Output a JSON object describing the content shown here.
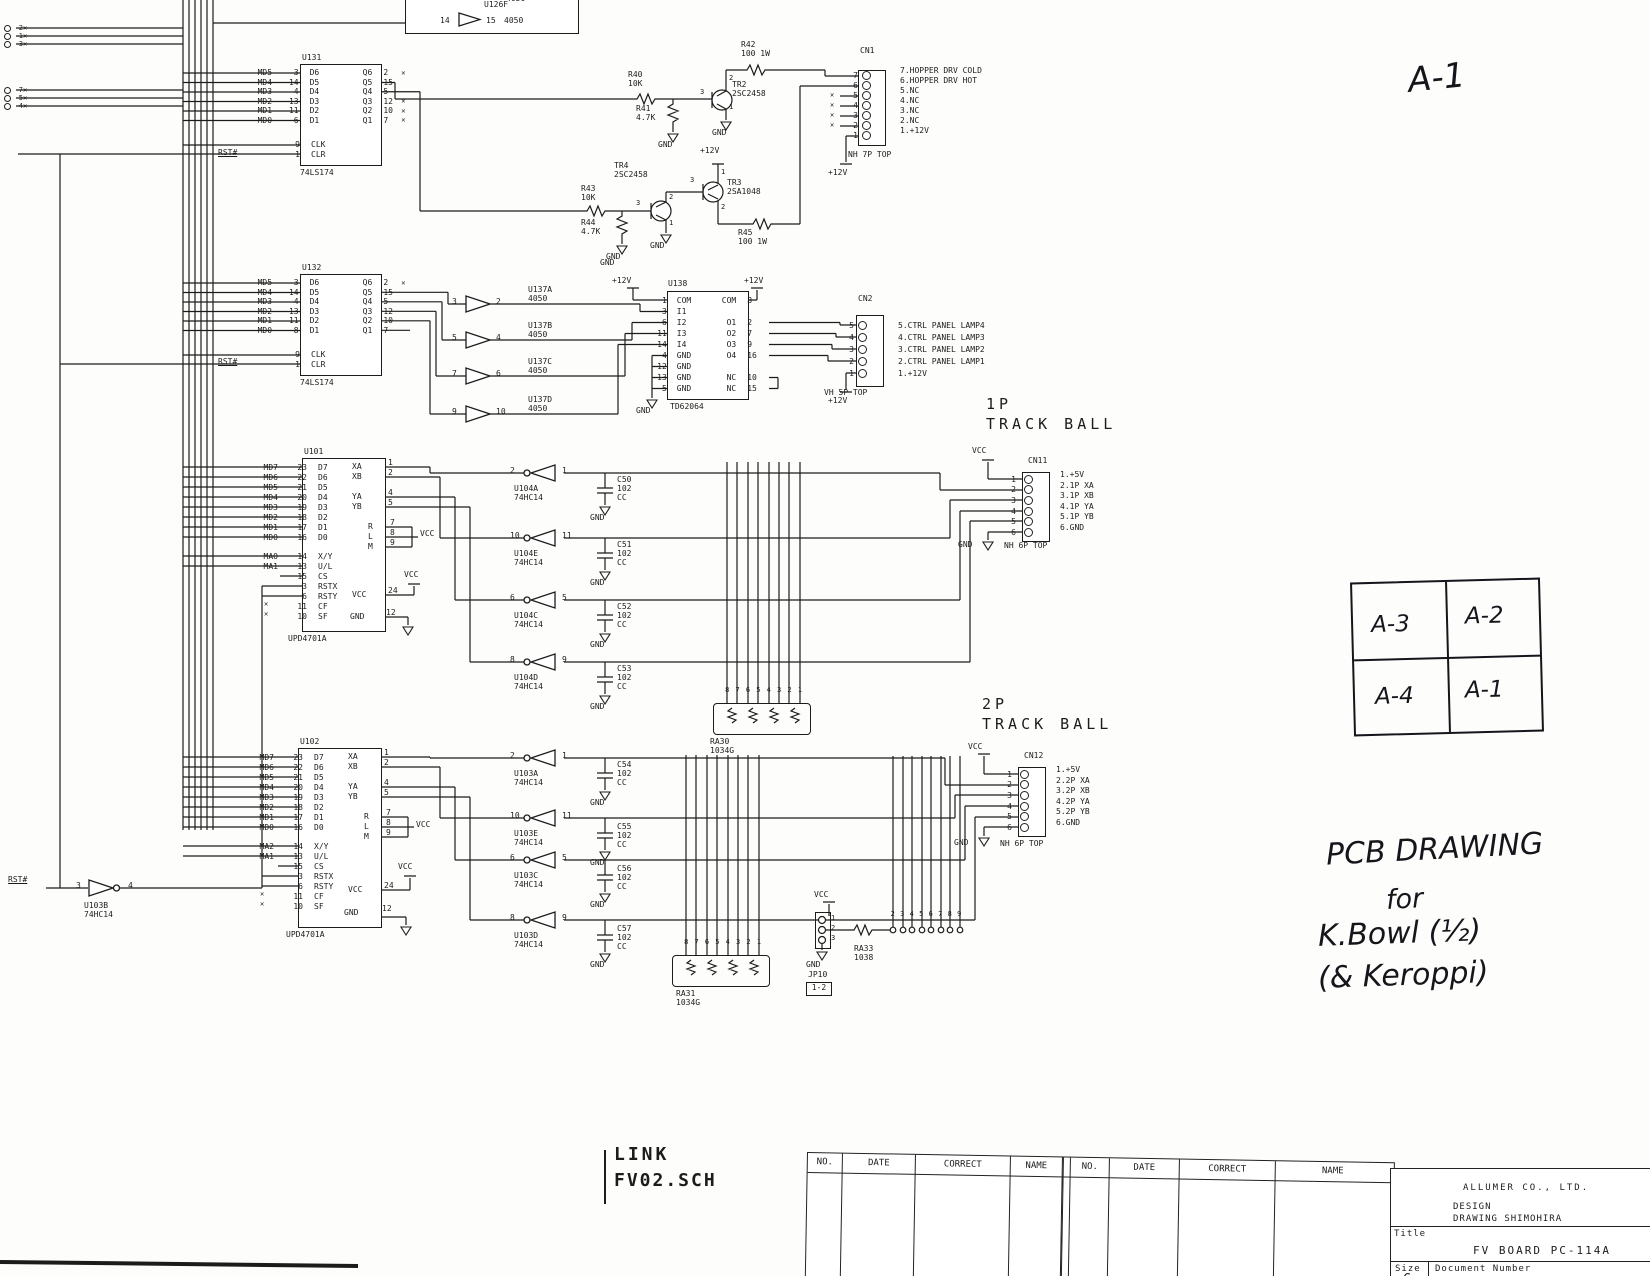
{
  "power": {
    "vcc": "VCC",
    "gnd": "GND",
    "v12": "+12V"
  },
  "rst": "RST#",
  "edge": {
    "stub1": [
      "2",
      "1",
      "3"
    ],
    "stub2": [
      "7",
      "5",
      "4"
    ]
  },
  "u126": {
    "ref": "U126F",
    "part": "4050",
    "part_above": "4050",
    "i": "14",
    "o": "15"
  },
  "u131": {
    "ref": "U131",
    "part": "74LS174",
    "clk": {
      "p": "9",
      "n": "CLK"
    },
    "clr": {
      "p": "1",
      "n": "CLR"
    },
    "rows": [
      {
        "s": "MD5",
        "lp": "3",
        "ln": "D6",
        "rn": "Q6",
        "rp": "2",
        "x": "✕"
      },
      {
        "s": "MD4",
        "lp": "14",
        "ln": "D5",
        "rn": "Q5",
        "rp": "15",
        "x": ""
      },
      {
        "s": "MD3",
        "lp": "4",
        "ln": "D4",
        "rn": "Q4",
        "rp": "5",
        "x": ""
      },
      {
        "s": "MD2",
        "lp": "13",
        "ln": "D3",
        "rn": "Q3",
        "rp": "12",
        "x": "✕"
      },
      {
        "s": "MD1",
        "lp": "11",
        "ln": "D2",
        "rn": "Q2",
        "rp": "10",
        "x": "✕"
      },
      {
        "s": "MD0",
        "lp": "6",
        "ln": "D1",
        "rn": "Q1",
        "rp": "7",
        "x": "✕"
      }
    ]
  },
  "u132": {
    "ref": "U132",
    "part": "74LS174",
    "clk": {
      "p": "9",
      "n": "CLK"
    },
    "clr": {
      "p": "1",
      "n": "CLR"
    },
    "rows": [
      {
        "s": "MD5",
        "lp": "3",
        "ln": "D6",
        "rn": "Q6",
        "rp": "2",
        "x": "✕"
      },
      {
        "s": "MD4",
        "lp": "14",
        "ln": "D5",
        "rn": "Q5",
        "rp": "15",
        "x": ""
      },
      {
        "s": "MD3",
        "lp": "4",
        "ln": "D4",
        "rn": "Q4",
        "rp": "5",
        "x": ""
      },
      {
        "s": "MD2",
        "lp": "13",
        "ln": "D3",
        "rn": "Q3",
        "rp": "12",
        "x": ""
      },
      {
        "s": "MD1",
        "lp": "11",
        "ln": "D2",
        "rn": "Q2",
        "rp": "10",
        "x": ""
      },
      {
        "s": "MD0",
        "lp": "8",
        "ln": "D1",
        "rn": "Q1",
        "rp": "7",
        "x": ""
      }
    ]
  },
  "hopper": {
    "r40": [
      "R40",
      "10K"
    ],
    "r41": [
      "R41",
      "4.7K"
    ],
    "r42": [
      "R42",
      "100 1W"
    ],
    "r43": [
      "R43",
      "10K"
    ],
    "r44": [
      "R44",
      "4.7K"
    ],
    "r45": [
      "R45",
      "100 1W"
    ],
    "tr2": [
      "TR2",
      "2SC2458"
    ],
    "tr3": [
      "TR3",
      "2SA1048"
    ],
    "tr4": [
      "TR4",
      "2SC2458"
    ],
    "pins": {
      "b": "3",
      "c": "2",
      "e": "1"
    }
  },
  "cn1": {
    "ref": "CN1",
    "type": "NH 7P TOP",
    "rows": [
      {
        "p": "7",
        "x": ""
      },
      {
        "p": "6",
        "x": ""
      },
      {
        "p": "5",
        "x": "✕"
      },
      {
        "p": "4",
        "x": "✕"
      },
      {
        "p": "3",
        "x": "✕"
      },
      {
        "p": "2",
        "x": "✕"
      },
      {
        "p": "1",
        "x": ""
      }
    ],
    "desc": [
      "7.HOPPER DRV COLD",
      "6.HOPPER DRV HOT",
      "5.NC",
      "4.NC",
      "3.NC",
      "2.NC",
      "1.+12V"
    ]
  },
  "u137": [
    {
      "ref": "U137A",
      "part": "4050",
      "i": "3",
      "o": "2"
    },
    {
      "ref": "U137B",
      "part": "4050",
      "i": "5",
      "o": "4"
    },
    {
      "ref": "U137C",
      "part": "4050",
      "i": "7",
      "o": "6"
    },
    {
      "ref": "U137D",
      "part": "4050",
      "i": "9",
      "o": "10"
    }
  ],
  "u138": {
    "ref": "U138",
    "part": "TD62064",
    "rows": [
      {
        "lp": "1",
        "ln": "COM",
        "rn": "COM",
        "rp": "8"
      },
      {
        "lp": "3",
        "ln": "I1",
        "rn": "",
        "rp": ""
      },
      {
        "lp": "6",
        "ln": "I2",
        "rn": "O1",
        "rp": "2"
      },
      {
        "lp": "11",
        "ln": "I3",
        "rn": "O2",
        "rp": "7"
      },
      {
        "lp": "14",
        "ln": "I4",
        "rn": "O3",
        "rp": "9"
      },
      {
        "lp": "4",
        "ln": "GND",
        "rn": "O4",
        "rp": "16"
      },
      {
        "lp": "12",
        "ln": "GND",
        "rn": "",
        "rp": ""
      },
      {
        "lp": "13",
        "ln": "GND",
        "rn": "NC",
        "rp": "10"
      },
      {
        "lp": "5",
        "ln": "GND",
        "rn": "NC",
        "rp": "15"
      }
    ]
  },
  "cn2": {
    "ref": "CN2",
    "type": "VH 5P TOP",
    "pins": [
      "5",
      "4",
      "3",
      "2",
      "1"
    ],
    "desc": [
      "5.CTRL PANEL LAMP4",
      "4.CTRL PANEL LAMP3",
      "3.CTRL PANEL LAMP2",
      "2.CTRL PANEL LAMP1",
      "1.+12V"
    ]
  },
  "tb1": [
    "1P",
    "TRACK BALL"
  ],
  "tb2": [
    "2P",
    "TRACK BALL"
  ],
  "cn11": {
    "ref": "CN11",
    "type": "NH 6P TOP",
    "pins": [
      "1",
      "2",
      "3",
      "4",
      "5",
      "6"
    ],
    "desc": [
      "1.+5V",
      "2.1P XA",
      "3.1P XB",
      "4.1P YA",
      "5.1P YB",
      "6.GND"
    ]
  },
  "cn12": {
    "ref": "CN12",
    "type": "NH 6P TOP",
    "pins": [
      "1",
      "2",
      "3",
      "4",
      "5",
      "6"
    ],
    "desc": [
      "1.+5V",
      "2.2P XA",
      "3.2P XB",
      "4.2P YA",
      "5.2P YB",
      "6.GND"
    ]
  },
  "u101": {
    "ref": "U101",
    "part": "UPD4701A",
    "data": [
      {
        "s": "MD7",
        "lp": "23",
        "ln": "D7"
      },
      {
        "s": "MD6",
        "lp": "22",
        "ln": "D6"
      },
      {
        "s": "MD5",
        "lp": "21",
        "ln": "D5"
      },
      {
        "s": "MD4",
        "lp": "20",
        "ln": "D4"
      },
      {
        "s": "MD3",
        "lp": "19",
        "ln": "D3"
      },
      {
        "s": "MD2",
        "lp": "18",
        "ln": "D2"
      },
      {
        "s": "MD1",
        "lp": "17",
        "ln": "D1"
      },
      {
        "s": "MD0",
        "lp": "16",
        "ln": "D0"
      }
    ],
    "ctl": [
      {
        "s": "MA0",
        "lp": "14",
        "ln": "X/Y"
      },
      {
        "s": "MA1",
        "lp": "13",
        "ln": "U/L"
      },
      {
        "s": "",
        "lp": "15",
        "ln": "CS"
      },
      {
        "s": "",
        "lp": "3",
        "ln": "RSTX"
      },
      {
        "s": "",
        "lp": "6",
        "ln": "RSTY"
      },
      {
        "s": "",
        "lp": "11",
        "ln": "CF"
      },
      {
        "s": "",
        "lp": "10",
        "ln": "SF"
      }
    ],
    "right": {
      "xa": [
        "XA",
        "1"
      ],
      "xb": [
        "XB",
        "2"
      ],
      "ya": [
        "YA",
        "4"
      ],
      "yb": [
        "YB",
        "5"
      ],
      "r": [
        "R",
        "7"
      ],
      "l": [
        "L",
        "8"
      ],
      "m": [
        "M",
        "9"
      ],
      "vcc": [
        "VCC",
        "24"
      ],
      "gnd": [
        "GND",
        "12"
      ]
    }
  },
  "u102": {
    "ref": "U102",
    "part": "UPD4701A",
    "data": [
      {
        "s": "MD7",
        "lp": "23",
        "ln": "D7"
      },
      {
        "s": "MD6",
        "lp": "22",
        "ln": "D6"
      },
      {
        "s": "MD5",
        "lp": "21",
        "ln": "D5"
      },
      {
        "s": "MD4",
        "lp": "20",
        "ln": "D4"
      },
      {
        "s": "MD3",
        "lp": "19",
        "ln": "D3"
      },
      {
        "s": "MD2",
        "lp": "18",
        "ln": "D2"
      },
      {
        "s": "MD1",
        "lp": "17",
        "ln": "D1"
      },
      {
        "s": "MD0",
        "lp": "16",
        "ln": "D0"
      }
    ],
    "ctl": [
      {
        "s": "MA2",
        "lp": "14",
        "ln": "X/Y"
      },
      {
        "s": "MA1",
        "lp": "13",
        "ln": "U/L"
      },
      {
        "s": "",
        "lp": "15",
        "ln": "CS"
      },
      {
        "s": "",
        "lp": "3",
        "ln": "RSTX"
      },
      {
        "s": "",
        "lp": "6",
        "ln": "RSTY"
      },
      {
        "s": "",
        "lp": "11",
        "ln": "CF"
      },
      {
        "s": "",
        "lp": "10",
        "ln": "SF"
      }
    ],
    "right": {
      "xa": [
        "XA",
        "1"
      ],
      "xb": [
        "XB",
        "2"
      ],
      "ya": [
        "YA",
        "4"
      ],
      "yb": [
        "YB",
        "5"
      ],
      "r": [
        "R",
        "7"
      ],
      "l": [
        "L",
        "8"
      ],
      "m": [
        "M",
        "9"
      ],
      "vcc": [
        "VCC",
        "24"
      ],
      "gnd": [
        "GND",
        "12"
      ]
    }
  },
  "u104": [
    {
      "ref": "U104A",
      "part": "74HC14",
      "o": "2",
      "i": "1"
    },
    {
      "ref": "U104E",
      "part": "74HC14",
      "o": "10",
      "i": "11"
    },
    {
      "ref": "U104C",
      "part": "74HC14",
      "o": "6",
      "i": "5"
    },
    {
      "ref": "U104D",
      "part": "74HC14",
      "o": "8",
      "i": "9"
    }
  ],
  "u103": [
    {
      "ref": "U103A",
      "part": "74HC14",
      "o": "2",
      "i": "1"
    },
    {
      "ref": "U103E",
      "part": "74HC14",
      "o": "10",
      "i": "11"
    },
    {
      "ref": "U103C",
      "part": "74HC14",
      "o": "6",
      "i": "5"
    },
    {
      "ref": "U103D",
      "part": "74HC14",
      "o": "8",
      "i": "9"
    },
    {
      "ref": "U103B",
      "part": "74HC14",
      "i": "3",
      "o": "4"
    }
  ],
  "caps1": [
    {
      "ref": "C50",
      "v": "102",
      "t": "CC"
    },
    {
      "ref": "C51",
      "v": "102",
      "t": "CC"
    },
    {
      "ref": "C52",
      "v": "102",
      "t": "CC"
    },
    {
      "ref": "C53",
      "v": "102",
      "t": "CC"
    }
  ],
  "caps2": [
    {
      "ref": "C54",
      "v": "102",
      "t": "CC"
    },
    {
      "ref": "C55",
      "v": "102",
      "t": "CC"
    },
    {
      "ref": "C56",
      "v": "102",
      "t": "CC"
    },
    {
      "ref": "C57",
      "v": "102",
      "t": "CC"
    }
  ],
  "ra30": {
    "ref": "RA30",
    "part": "1034G",
    "pins": [
      "8",
      "7",
      "6",
      "5",
      "4",
      "3",
      "2",
      "1"
    ]
  },
  "ra31": {
    "ref": "RA31",
    "part": "1034G",
    "pins": [
      "8",
      "7",
      "6",
      "5",
      "4",
      "3",
      "2",
      "1"
    ]
  },
  "ra33": {
    "ref": "RA33",
    "part": "1038",
    "pins": [
      "2",
      "3",
      "4",
      "5",
      "6",
      "7",
      "8",
      "9"
    ]
  },
  "jp10": {
    "ref": "JP10",
    "pins": [
      "1",
      "2",
      "3"
    ],
    "note": "1-2"
  },
  "sheet": {
    "mark": "A-1",
    "grid": {
      "tl": "A-3",
      "tr": "A-2",
      "bl": "A-4",
      "br": "A-1"
    },
    "note": [
      "PCB DRAWING",
      "for",
      "K.Bowl (½)",
      "(& Keroppi)"
    ],
    "link": [
      "LINK",
      "FV02.SCH"
    ]
  },
  "footer": {
    "rev_headers": [
      "NO.",
      "DATE",
      "CORRECT",
      "NAME"
    ],
    "company": "ALLUMER CO., LTD.",
    "design": "DESIGN",
    "drawing": "DRAWING SHIMOHIRA",
    "title_label": "Title",
    "title": "FV BOARD PC-114A",
    "size_label": "Size",
    "size": "C",
    "doc_label": "Document Number"
  }
}
